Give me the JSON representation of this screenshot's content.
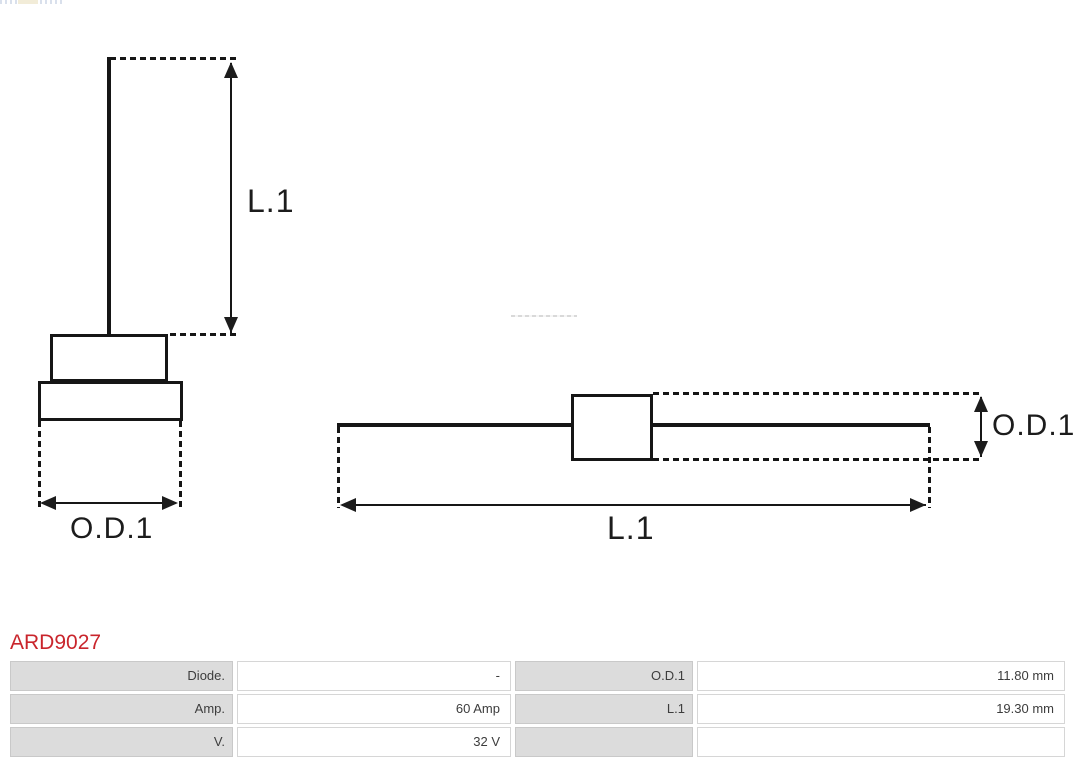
{
  "diagram": {
    "left_figure": {
      "name": "press-fit diode front view",
      "length_label": "L.1",
      "diameter_label": "O.D.1"
    },
    "right_figure": {
      "name": "diode side view with axial leads",
      "length_label": "L.1",
      "diameter_label": "O.D.1"
    }
  },
  "product": {
    "part_number": "ARD9027",
    "specs": {
      "rows": [
        {
          "label1": "Diode.",
          "value1": "-",
          "label2": "O.D.1",
          "value2": "11.80 mm"
        },
        {
          "label1": "Amp.",
          "value1": "60 Amp",
          "label2": "L.1",
          "value2": "19.30 mm"
        },
        {
          "label1": "V.",
          "value1": "32 V",
          "label2": "",
          "value2": ""
        }
      ]
    }
  },
  "colors": {
    "accent_red": "#c9252c",
    "drawing_line": "#161616",
    "table_label_bg": "#dcdcdc",
    "table_border": "#cccccc"
  }
}
